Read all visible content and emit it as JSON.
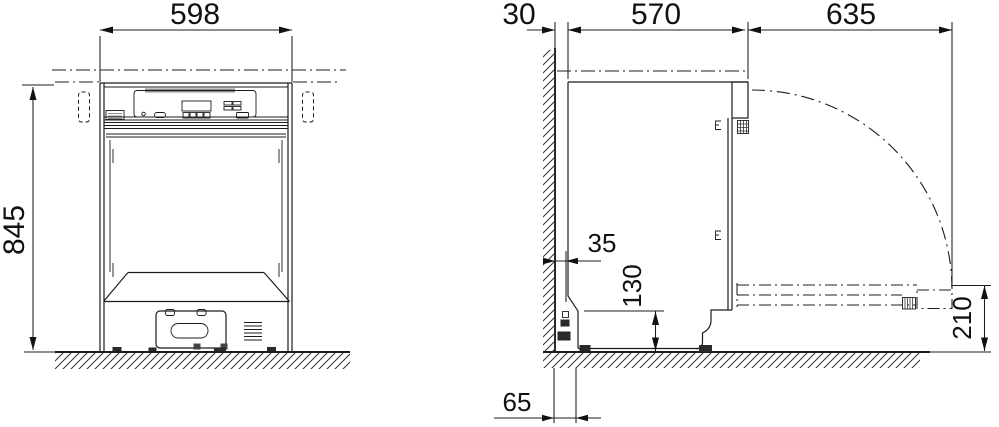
{
  "dimensions": {
    "front": {
      "width": "598",
      "height": "845"
    },
    "side": {
      "top_wall_clearance": "30",
      "body_depth": "570",
      "open_door_projection": "635",
      "bottom_wall_clearance": "35",
      "plinth_recess_height": "130",
      "open_door_floor_clearance": "210",
      "rear_base_clearance": "65"
    }
  }
}
